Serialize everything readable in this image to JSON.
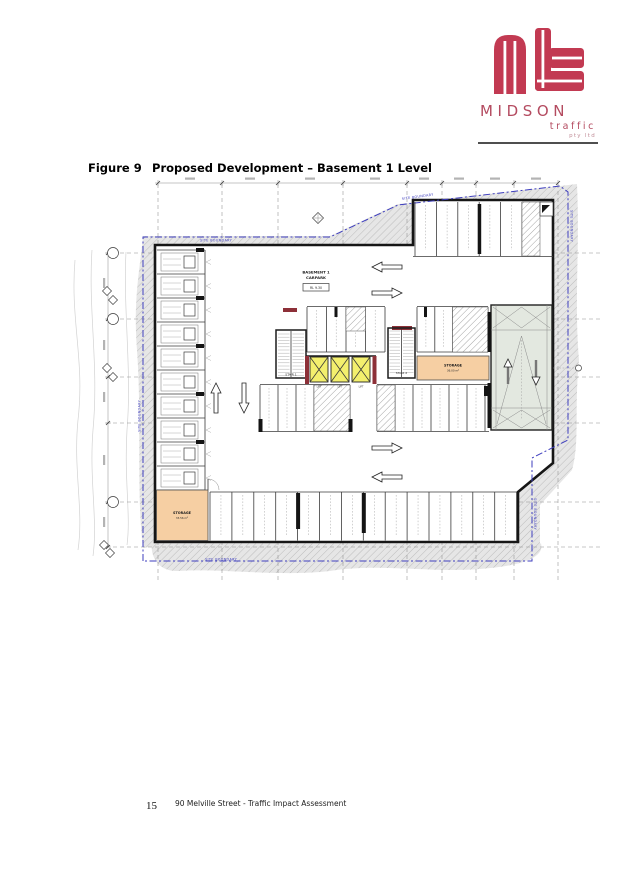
{
  "logo": {
    "brand": "MIDSON",
    "tagline": "traffic",
    "suffix": "pty ltd"
  },
  "figure": {
    "label": "Figure 9",
    "title": "Proposed Development – Basement 1 Level"
  },
  "plan": {
    "site_boundary": "SITE BOUNDARY",
    "carpark_line1": "BASEMENT 1",
    "carpark_line2": "CARPARK",
    "level_tag": "RL 9.30",
    "stair1": "STAIR 1",
    "stair2": "STAIR 2",
    "lift": "LIFT",
    "storage_mid": {
      "label": "STORAGE",
      "area": "36.00 m²"
    },
    "storage_sw": {
      "label": "STORAGE",
      "area": "33.56 m²"
    }
  },
  "footer": {
    "page_number": "15",
    "doc_title": "90 Melville Street - Traffic Impact Assessment"
  },
  "colors": {
    "brand_red": "#c23a52",
    "boundary_blue": "#3d3dbe",
    "storage_orange": "#f6cfa3",
    "lift_yellow": "#f3ef6d"
  }
}
